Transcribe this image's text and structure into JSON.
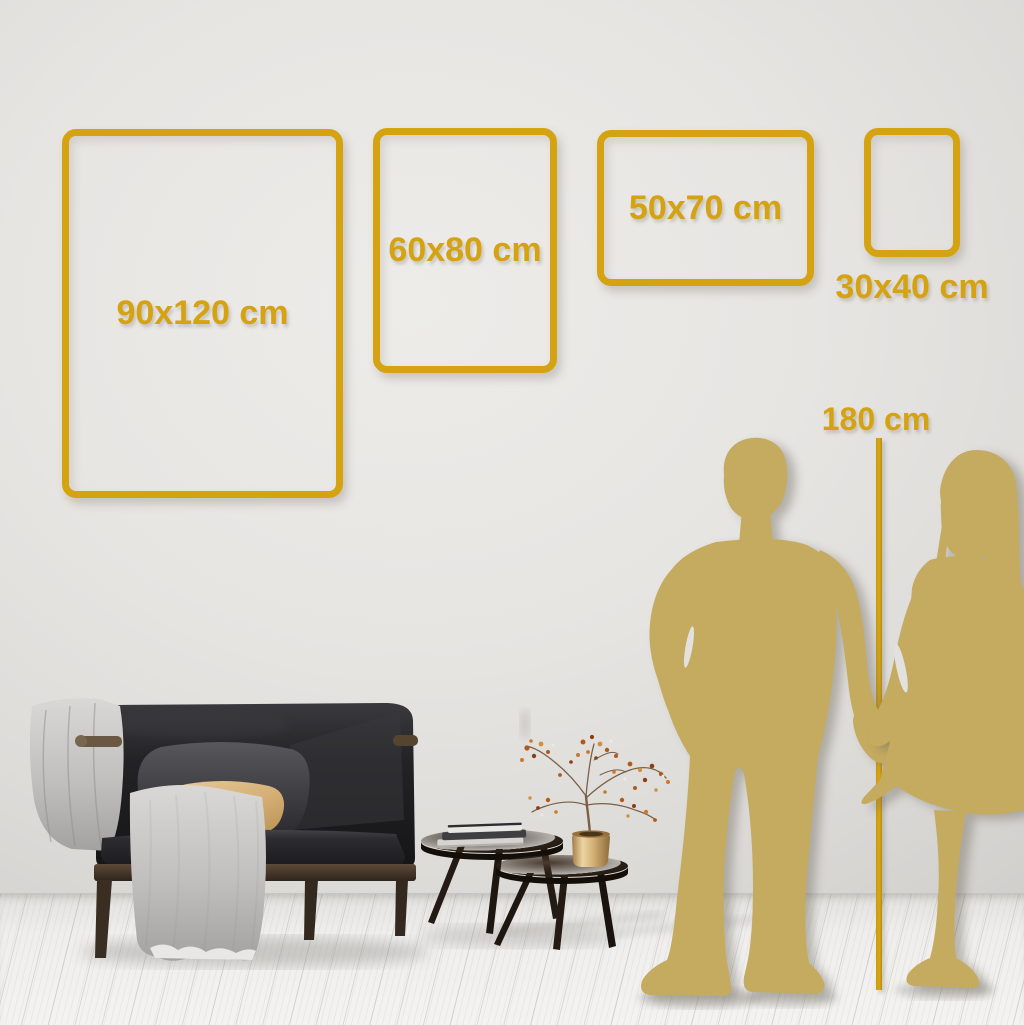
{
  "scene": {
    "frames": [
      {
        "id": "90x120",
        "label": "90x120 cm"
      },
      {
        "id": "60x80",
        "label": "60x80 cm"
      },
      {
        "id": "50x70",
        "label": "50x70 cm"
      },
      {
        "id": "30x40",
        "label": "30x40 cm"
      }
    ],
    "height_marker": {
      "label": "180 cm"
    },
    "colors": {
      "accent_gold": "#d5a212",
      "silhouette_gold": "#c5ab5f",
      "wall": "#e5e3e0",
      "floor": "#f1f0ee"
    }
  }
}
